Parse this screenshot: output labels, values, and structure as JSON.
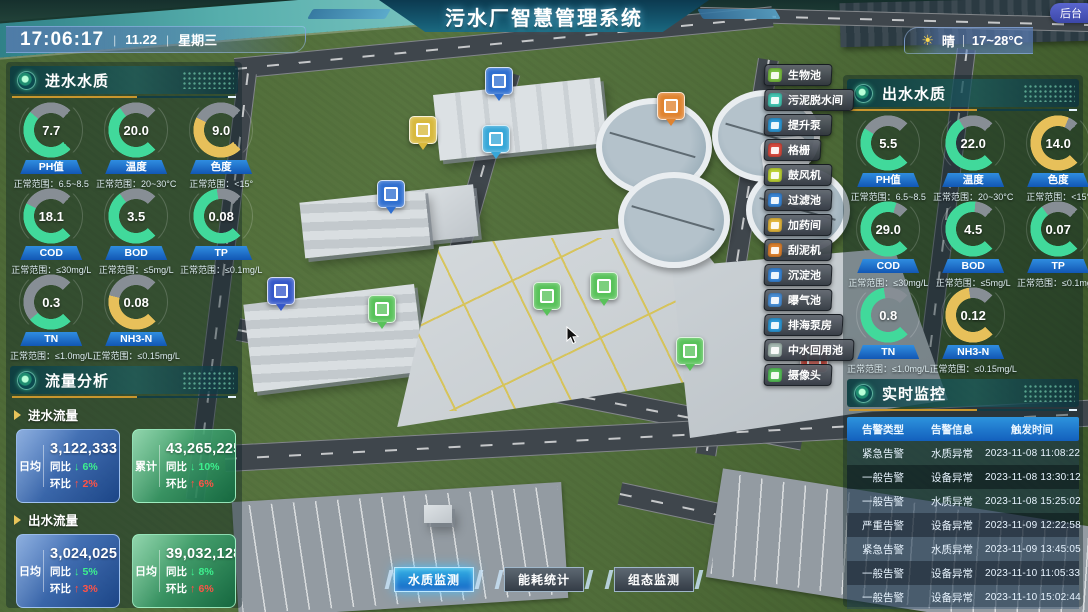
{
  "header": {
    "title": "污水厂智慧管理系统",
    "time": "17:06:17",
    "date": "11.22",
    "weekday": "星期三",
    "weather": "晴",
    "temp_range": "17~28°C",
    "admin_label": "后台"
  },
  "inlet_panel": {
    "title": "进水水质",
    "gauges": [
      {
        "label": "PH值",
        "value": "7.7",
        "range": "正常范围：6.5~8.5",
        "color": "#41d99b",
        "fill": 0.65
      },
      {
        "label": "温度",
        "value": "20.0",
        "range": "正常范围：20~30°C",
        "color": "#41d99b",
        "fill": 0.7
      },
      {
        "label": "色度",
        "value": "9.0",
        "range": "正常范围：<15°",
        "color": "#e7c05a",
        "fill": 0.6
      },
      {
        "label": "COD",
        "value": "18.1",
        "range": "正常范围：≤30mg/L",
        "color": "#41d99b",
        "fill": 0.6
      },
      {
        "label": "BOD",
        "value": "3.5",
        "range": "正常范围：≤5mg/L",
        "color": "#41d99b",
        "fill": 0.7
      },
      {
        "label": "TP",
        "value": "0.08",
        "range": "正常范围：≤0.1mg/L",
        "color": "#41d99b",
        "fill": 0.8
      },
      {
        "label": "TN",
        "value": "0.3",
        "range": "正常范围：≤1.0mg/L",
        "color": "#41d99b",
        "fill": 0.35
      },
      {
        "label": "NH3-N",
        "value": "0.08",
        "range": "正常范围：≤0.15mg/L",
        "color": "#e7c05a",
        "fill": 0.55
      }
    ]
  },
  "outlet_panel": {
    "title": "出水水质",
    "gauges": [
      {
        "label": "PH值",
        "value": "5.5",
        "range": "正常范围：6.5~8.5",
        "color": "#41d99b",
        "fill": 0.62
      },
      {
        "label": "温度",
        "value": "22.0",
        "range": "正常范围：20~30°C",
        "color": "#41d99b",
        "fill": 0.72
      },
      {
        "label": "色度",
        "value": "14.0",
        "range": "正常范围：<15°",
        "color": "#e7c05a",
        "fill": 0.92
      },
      {
        "label": "COD",
        "value": "29.0",
        "range": "正常范围：≤30mg/L",
        "color": "#41d99b",
        "fill": 0.9
      },
      {
        "label": "BOD",
        "value": "4.5",
        "range": "正常范围：≤5mg/L",
        "color": "#41d99b",
        "fill": 0.85
      },
      {
        "label": "TP",
        "value": "0.07",
        "range": "正常范围：≤0.1mg/L",
        "color": "#41d99b",
        "fill": 0.7
      },
      {
        "label": "TN",
        "value": "0.8",
        "range": "正常范围：≤1.0mg/L",
        "color": "#41d99b",
        "fill": 0.8
      },
      {
        "label": "NH3-N",
        "value": "0.12",
        "range": "正常范围：≤0.15mg/L",
        "color": "#e7c05a",
        "fill": 0.8
      }
    ]
  },
  "flow_panel": {
    "title": "流量分析",
    "sections": [
      {
        "label": "进水流量",
        "cards": [
          {
            "tag": "日均",
            "value": "3,122,333",
            "unit": "t",
            "theme": "blue",
            "metrics": [
              {
                "label": "同比",
                "dir": "down",
                "pct": "6%"
              },
              {
                "label": "环比",
                "dir": "up",
                "pct": "2%"
              }
            ]
          },
          {
            "tag": "累计",
            "value": "43,265,225",
            "unit": "t",
            "theme": "green",
            "metrics": [
              {
                "label": "同比",
                "dir": "down",
                "pct": "10%"
              },
              {
                "label": "环比",
                "dir": "up",
                "pct": "6%"
              }
            ]
          }
        ]
      },
      {
        "label": "出水流量",
        "cards": [
          {
            "tag": "日均",
            "value": "3,024,025",
            "unit": "t",
            "theme": "blue",
            "metrics": [
              {
                "label": "同比",
                "dir": "down",
                "pct": "5%"
              },
              {
                "label": "环比",
                "dir": "up",
                "pct": "3%"
              }
            ]
          },
          {
            "tag": "日均",
            "value": "39,032,128",
            "unit": "t",
            "theme": "green",
            "metrics": [
              {
                "label": "同比",
                "dir": "down",
                "pct": "8%"
              },
              {
                "label": "环比",
                "dir": "up",
                "pct": "6%"
              }
            ]
          }
        ]
      }
    ]
  },
  "monitor_panel": {
    "title": "实时监控",
    "columns": [
      "告警类型",
      "告警信息",
      "触发时间"
    ],
    "rows": [
      [
        "紧急告警",
        "水质异常",
        "2023-11-08 11:08:22"
      ],
      [
        "一般告警",
        "设备异常",
        "2023-11-08 13:30:12"
      ],
      [
        "一般告警",
        "水质异常",
        "2023-11-08 15:25:02"
      ],
      [
        "严重告警",
        "设备异常",
        "2023-11-09 12:22:58"
      ],
      [
        "紧急告警",
        "水质异常",
        "2023-11-09 13:45:05"
      ],
      [
        "一般告警",
        "设备异常",
        "2023-11-10 11:05:33"
      ],
      [
        "一般告警",
        "设备异常",
        "2023-11-10 15:02:44"
      ]
    ]
  },
  "facility_buttons": [
    {
      "label": "生物池",
      "icon": "bio-pool-icon",
      "color": "#7cc043"
    },
    {
      "label": "污泥脱水间",
      "icon": "sludge-dewatering-icon",
      "color": "#45c7b4"
    },
    {
      "label": "提升泵",
      "icon": "lift-pump-icon",
      "color": "#2e9ad8"
    },
    {
      "label": "格栅",
      "icon": "bar-screen-icon",
      "color": "#d84b3f"
    },
    {
      "label": "鼓风机",
      "icon": "blower-fan-icon",
      "color": "#bed436"
    },
    {
      "label": "过滤池",
      "icon": "filter-pool-icon",
      "color": "#3a87d8"
    },
    {
      "label": "加药间",
      "icon": "dosing-room-icon",
      "color": "#e5b93e"
    },
    {
      "label": "刮泥机",
      "icon": "mud-scraper-icon",
      "color": "#e0832f"
    },
    {
      "label": "沉淀池",
      "icon": "sedimentation-pool-icon",
      "color": "#3a87d8"
    },
    {
      "label": "曝气池",
      "icon": "aeration-pool-icon",
      "color": "#4a90d8"
    },
    {
      "label": "排海泵房",
      "icon": "sea-discharge-pump-icon",
      "color": "#2e9ad8"
    },
    {
      "label": "中水回用池",
      "icon": "water-reuse-pool-icon",
      "color": "#a8bdb5"
    },
    {
      "label": "摄像头",
      "icon": "camera-icon",
      "color": "#58c25a"
    }
  ],
  "bottom_tabs": [
    {
      "label": "水质监测",
      "active": true
    },
    {
      "label": "能耗统计",
      "active": false
    },
    {
      "label": "组态监测",
      "active": false
    }
  ],
  "scene_markers": [
    {
      "name": "sedimentation-marker",
      "x": 485,
      "y": 67,
      "color": "#2f6fd0"
    },
    {
      "name": "blower-marker",
      "x": 409,
      "y": 116,
      "color": "#d8b93c"
    },
    {
      "name": "lift-pump-marker",
      "x": 482,
      "y": 125,
      "color": "#37a7d8"
    },
    {
      "name": "scraper-marker",
      "x": 657,
      "y": 92,
      "color": "#e0832f"
    },
    {
      "name": "aeration-marker",
      "x": 377,
      "y": 180,
      "color": "#2f6fd0"
    },
    {
      "name": "filter-pool-marker",
      "x": 267,
      "y": 277,
      "color": "#3558c9"
    },
    {
      "name": "reuse-pool-marker",
      "x": 368,
      "y": 295,
      "color": "#58c25a"
    },
    {
      "name": "bio-pool-marker",
      "x": 533,
      "y": 282,
      "color": "#58c25a"
    },
    {
      "name": "camera-marker-1",
      "x": 590,
      "y": 272,
      "color": "#58c25a"
    },
    {
      "name": "camera-marker-2",
      "x": 676,
      "y": 337,
      "color": "#58c25a"
    },
    {
      "name": "screen-alert-marker",
      "x": 800,
      "y": 345,
      "color": "#d84b3f"
    }
  ]
}
